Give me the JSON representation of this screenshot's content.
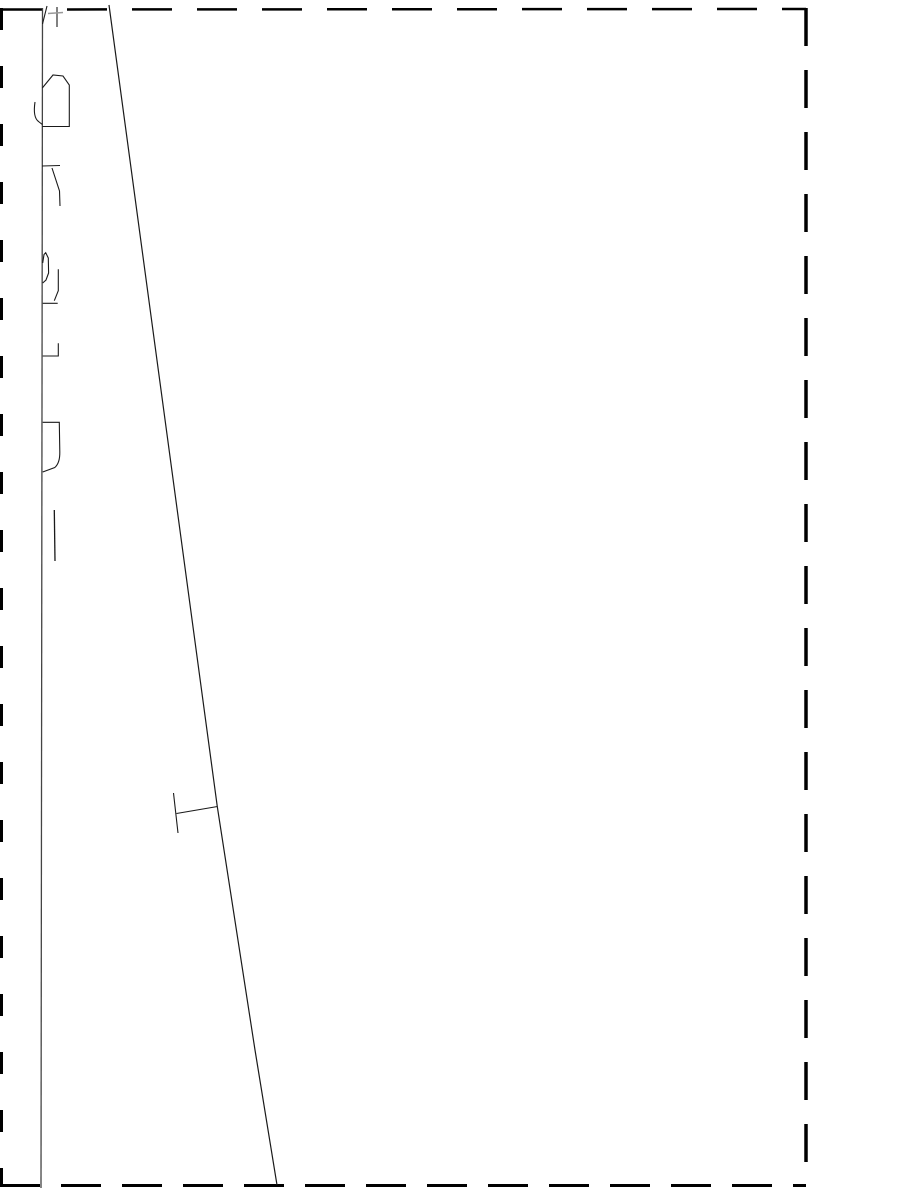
{
  "page": {
    "width": 918,
    "height": 1188,
    "background": "#ffffff"
  },
  "chart_data": {
    "type": "line",
    "title": "",
    "xlabel": "",
    "ylabel": "",
    "axis_text_visible": false,
    "grid": false,
    "legend": false,
    "note": "No numeric tick values, legend or readable labels are visible; geometry captured in page pixel coordinates.",
    "series": [
      {
        "name": "data-line",
        "points_px": [
          [
            109,
            5
          ],
          [
            217,
            807
          ],
          [
            255,
            1050
          ],
          [
            277,
            1185
          ]
        ]
      }
    ],
    "error_bars_px": [
      {
        "at": [
          217,
          807
        ],
        "whisker_to": [
          176,
          813
        ],
        "cap_from": [
          173.5,
          793
        ],
        "cap_to": [
          178,
          833
        ]
      }
    ]
  },
  "drawing": {
    "default_stroke": "#1a1a1a",
    "default_width": 1.1,
    "colors": {
      "border": "#000000",
      "axis": "#444444",
      "faint": "#999999"
    },
    "elements": [
      {
        "name": "page-border-top",
        "type": "line",
        "x1": 2,
        "y1": 9.5,
        "x2": 806,
        "y2": 9,
        "stroke": "#000000",
        "width": 2.5,
        "dash": "40,25"
      },
      {
        "name": "page-border-right",
        "type": "line",
        "x1": 806,
        "y1": 8,
        "x2": 806,
        "y2": 1186,
        "stroke": "#000000",
        "width": 3.5,
        "dash": "38,24"
      },
      {
        "name": "page-border-bottom",
        "type": "line",
        "x1": 0,
        "y1": 1185.5,
        "x2": 806,
        "y2": 1185.5,
        "stroke": "#000000",
        "width": 3,
        "dash": "40,21"
      },
      {
        "name": "page-border-left",
        "type": "line",
        "x1": 1.5,
        "y1": 8,
        "x2": 1.5,
        "y2": 1186,
        "stroke": "#000000",
        "width": 3,
        "dash": "22,36"
      },
      {
        "name": "axis-line",
        "type": "line",
        "x1": 42.5,
        "y1": 8,
        "x2": 41,
        "y2": 1188,
        "stroke": "#444444",
        "width": 1.3
      },
      {
        "name": "data-line",
        "type": "path",
        "d": "M 109,5 L 217.3,806.7 L 255,1050 L 277,1185",
        "width": 1.2
      },
      {
        "name": "errorbar-whisker",
        "type": "line",
        "x1": 176.5,
        "y1": 813.5,
        "x2": 217.5,
        "y2": 806.5,
        "width": 1.1
      },
      {
        "name": "errorbar-cap",
        "type": "line",
        "x1": 173.5,
        "y1": 793,
        "x2": 178,
        "y2": 833,
        "width": 1.1
      },
      {
        "name": "rotated-text-glyph-1-slash",
        "type": "line",
        "x1": 47,
        "y1": 6,
        "x2": 42.5,
        "y2": 24,
        "width": 1.1
      },
      {
        "name": "rotated-text-glyph-1-stem",
        "type": "line",
        "x1": 57,
        "y1": 7,
        "x2": 57,
        "y2": 27,
        "width": 1.1
      },
      {
        "name": "rotated-text-glyph-1-crossbar",
        "type": "line",
        "x1": 48,
        "y1": 13.5,
        "x2": 63,
        "y2": 12.5,
        "stroke": "#999999",
        "width": 1.6
      },
      {
        "name": "rotated-text-glyph-2-bowl",
        "type": "path",
        "d": "M 42.3,88 L 53,75 L 63,76 L 69.3,85 L 69.3,126.5 L 42.3,126.5",
        "width": 1.1
      },
      {
        "name": "rotated-text-glyph-2-hook",
        "type": "path",
        "d": "M 35,102 C 33.5,112 34.5,118.5 38.5,121.5 L 42.3,124.5",
        "width": 1.1
      },
      {
        "name": "rotated-text-glyph-3-bar",
        "type": "line",
        "x1": 42,
        "y1": 166,
        "x2": 60,
        "y2": 165.5,
        "width": 1.1
      },
      {
        "name": "rotated-text-glyph-3-leg",
        "type": "path",
        "d": "M 52,168 L 59.5,191 L 60,206",
        "width": 1.1
      },
      {
        "name": "rotated-text-glyph-4-loop",
        "type": "path",
        "d": "M 42.7,263 L 44,254.5 L 45.7,252.7 L 48.3,258 L 48.6,273 L 46,280 L 42.7,283",
        "width": 1.1
      },
      {
        "name": "rotated-text-glyph-4-stroke",
        "type": "path",
        "d": "M 58.3,269.3 L 58.3,290.7 L 54.3,300.7",
        "width": 1.1
      },
      {
        "name": "rotated-text-glyph-4-bar",
        "type": "line",
        "x1": 42.7,
        "y1": 303.3,
        "x2": 57.7,
        "y2": 303.3,
        "width": 1.1
      },
      {
        "name": "rotated-text-glyph-5-corner",
        "type": "path",
        "d": "M 58.3,343.3 L 58.3,356 L 42.7,356",
        "width": 1.1
      },
      {
        "name": "rotated-text-glyph-6-box",
        "type": "path",
        "d": "M 42.7,422.3 L 59.3,422.3 L 59.8,452 Q 60,463 54.8,467.5 L 42.7,472",
        "width": 1.1
      },
      {
        "name": "rotated-text-glyph-7-bar",
        "type": "line",
        "x1": 54.3,
        "y1": 510,
        "x2": 55,
        "y2": 561,
        "width": 1.3
      }
    ]
  }
}
